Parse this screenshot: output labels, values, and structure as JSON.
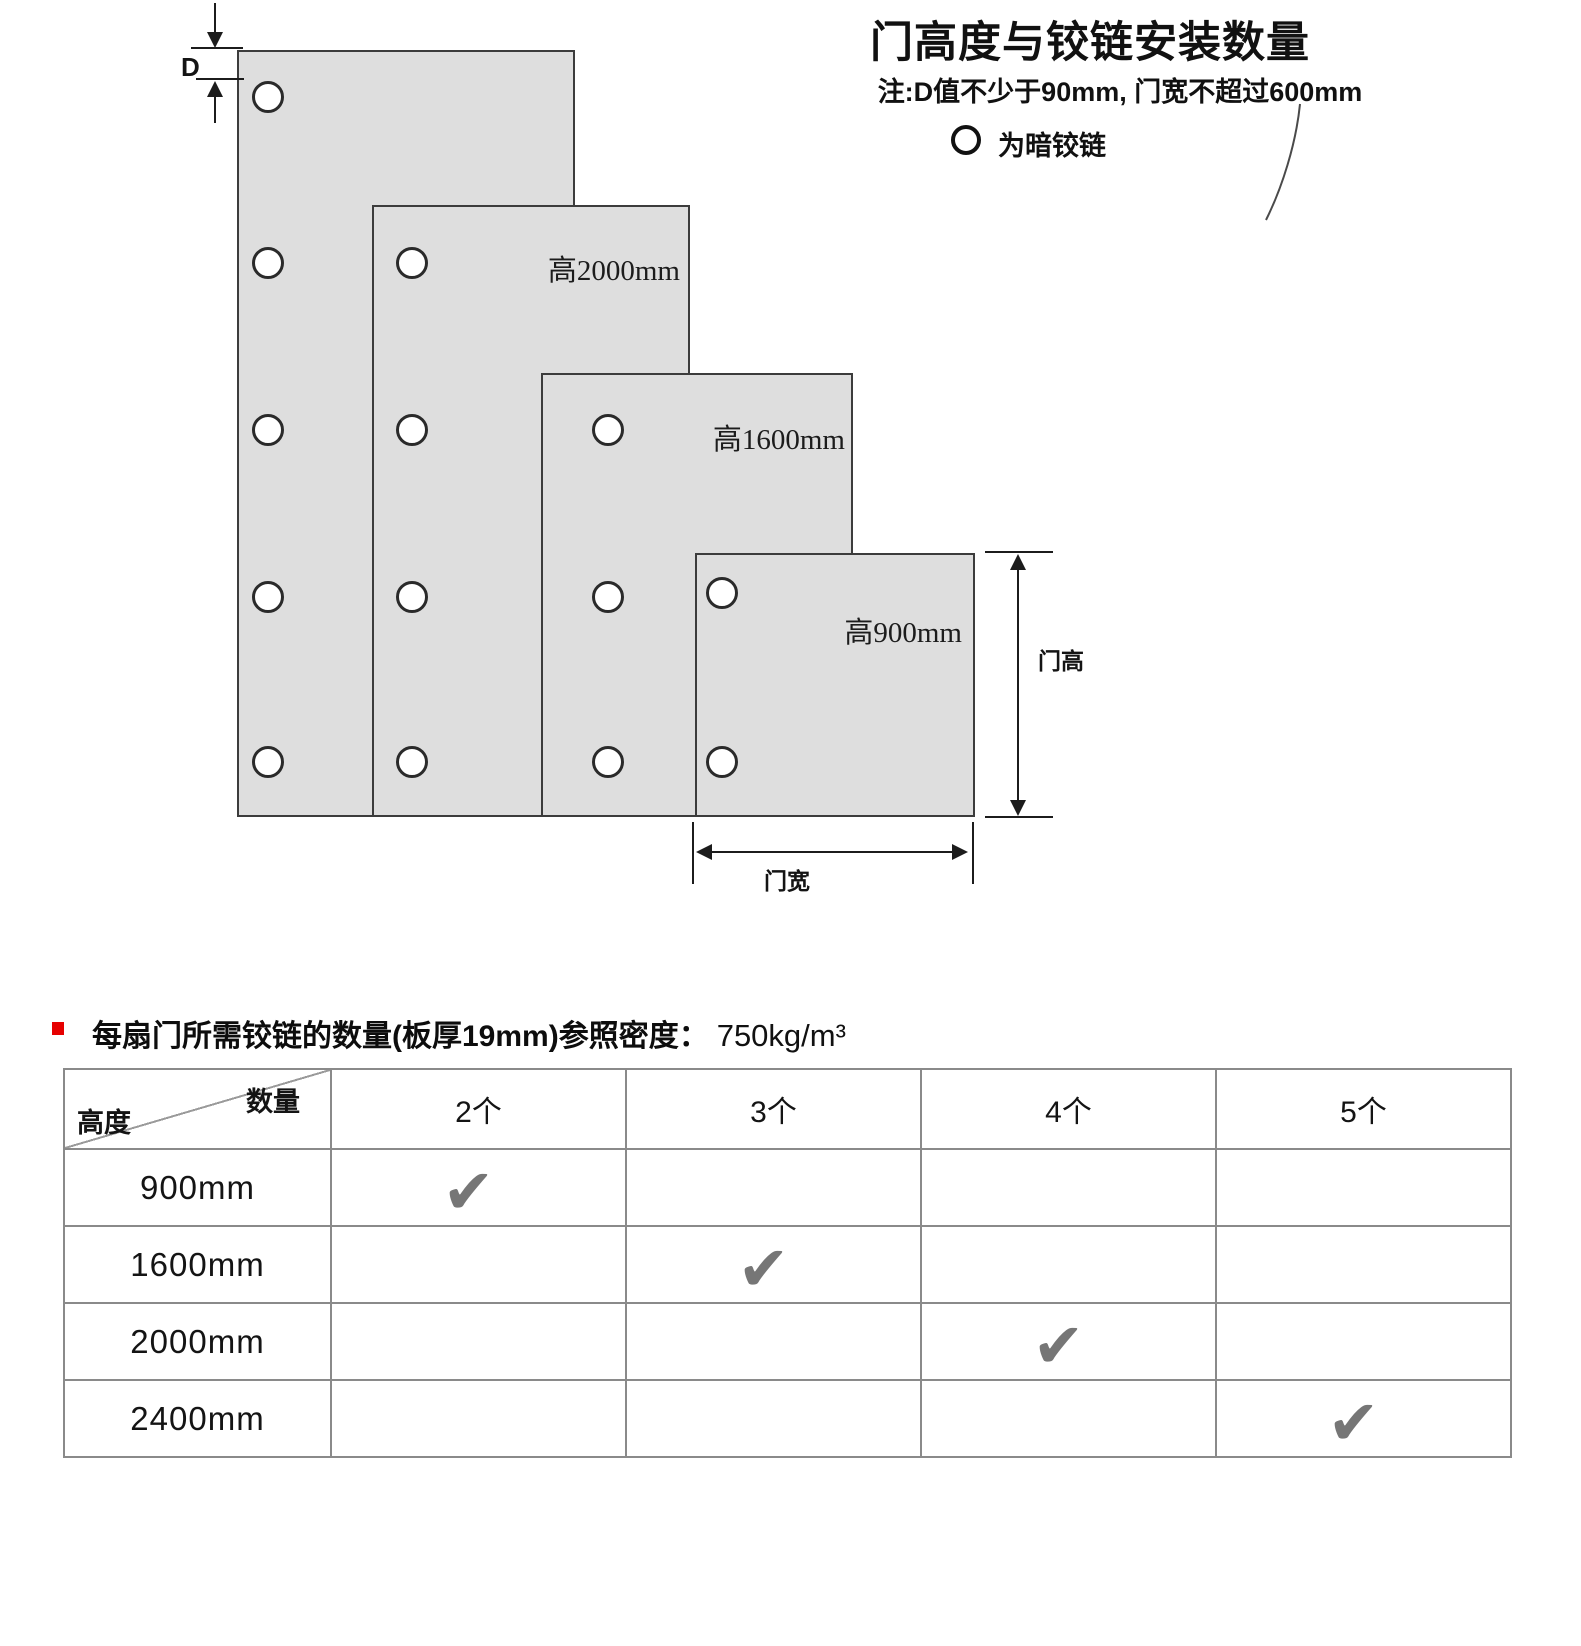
{
  "title": "门高度与铰链安装数量",
  "note": "注:D值不少于90mm, 门宽不超过600mm",
  "legend": {
    "label": "为暗铰链"
  },
  "diagram": {
    "d_label": "D",
    "door_height_label": "门高",
    "door_width_label": "门宽",
    "doors": [
      {
        "name": "door-2400mm",
        "height_label": "",
        "hinge_count": 5
      },
      {
        "name": "door-2000mm",
        "height_label": "高2000mm",
        "hinge_count": 4
      },
      {
        "name": "door-1600mm",
        "height_label": "高1600mm",
        "hinge_count": 3
      },
      {
        "name": "door-900mm",
        "height_label": "高900mm",
        "hinge_count": 2
      }
    ]
  },
  "section": {
    "heading": "每扇门所需铰链的数量(板厚19mm)参照密度：",
    "density": "750kg/m³"
  },
  "table": {
    "corner_top_right": "数量",
    "corner_bottom_left": "高度",
    "columns": [
      "2个",
      "3个",
      "4个",
      "5个"
    ],
    "rows": [
      {
        "height": "900mm",
        "check_col": "2个"
      },
      {
        "height": "1600mm",
        "check_col": "3个"
      },
      {
        "height": "2000mm",
        "check_col": "4个"
      },
      {
        "height": "2400mm",
        "check_col": "5个"
      }
    ],
    "check_glyph": "✔"
  },
  "colors": {
    "accent_red": "#e60000",
    "door_fill": "#dedede",
    "check_gray": "#767676"
  }
}
